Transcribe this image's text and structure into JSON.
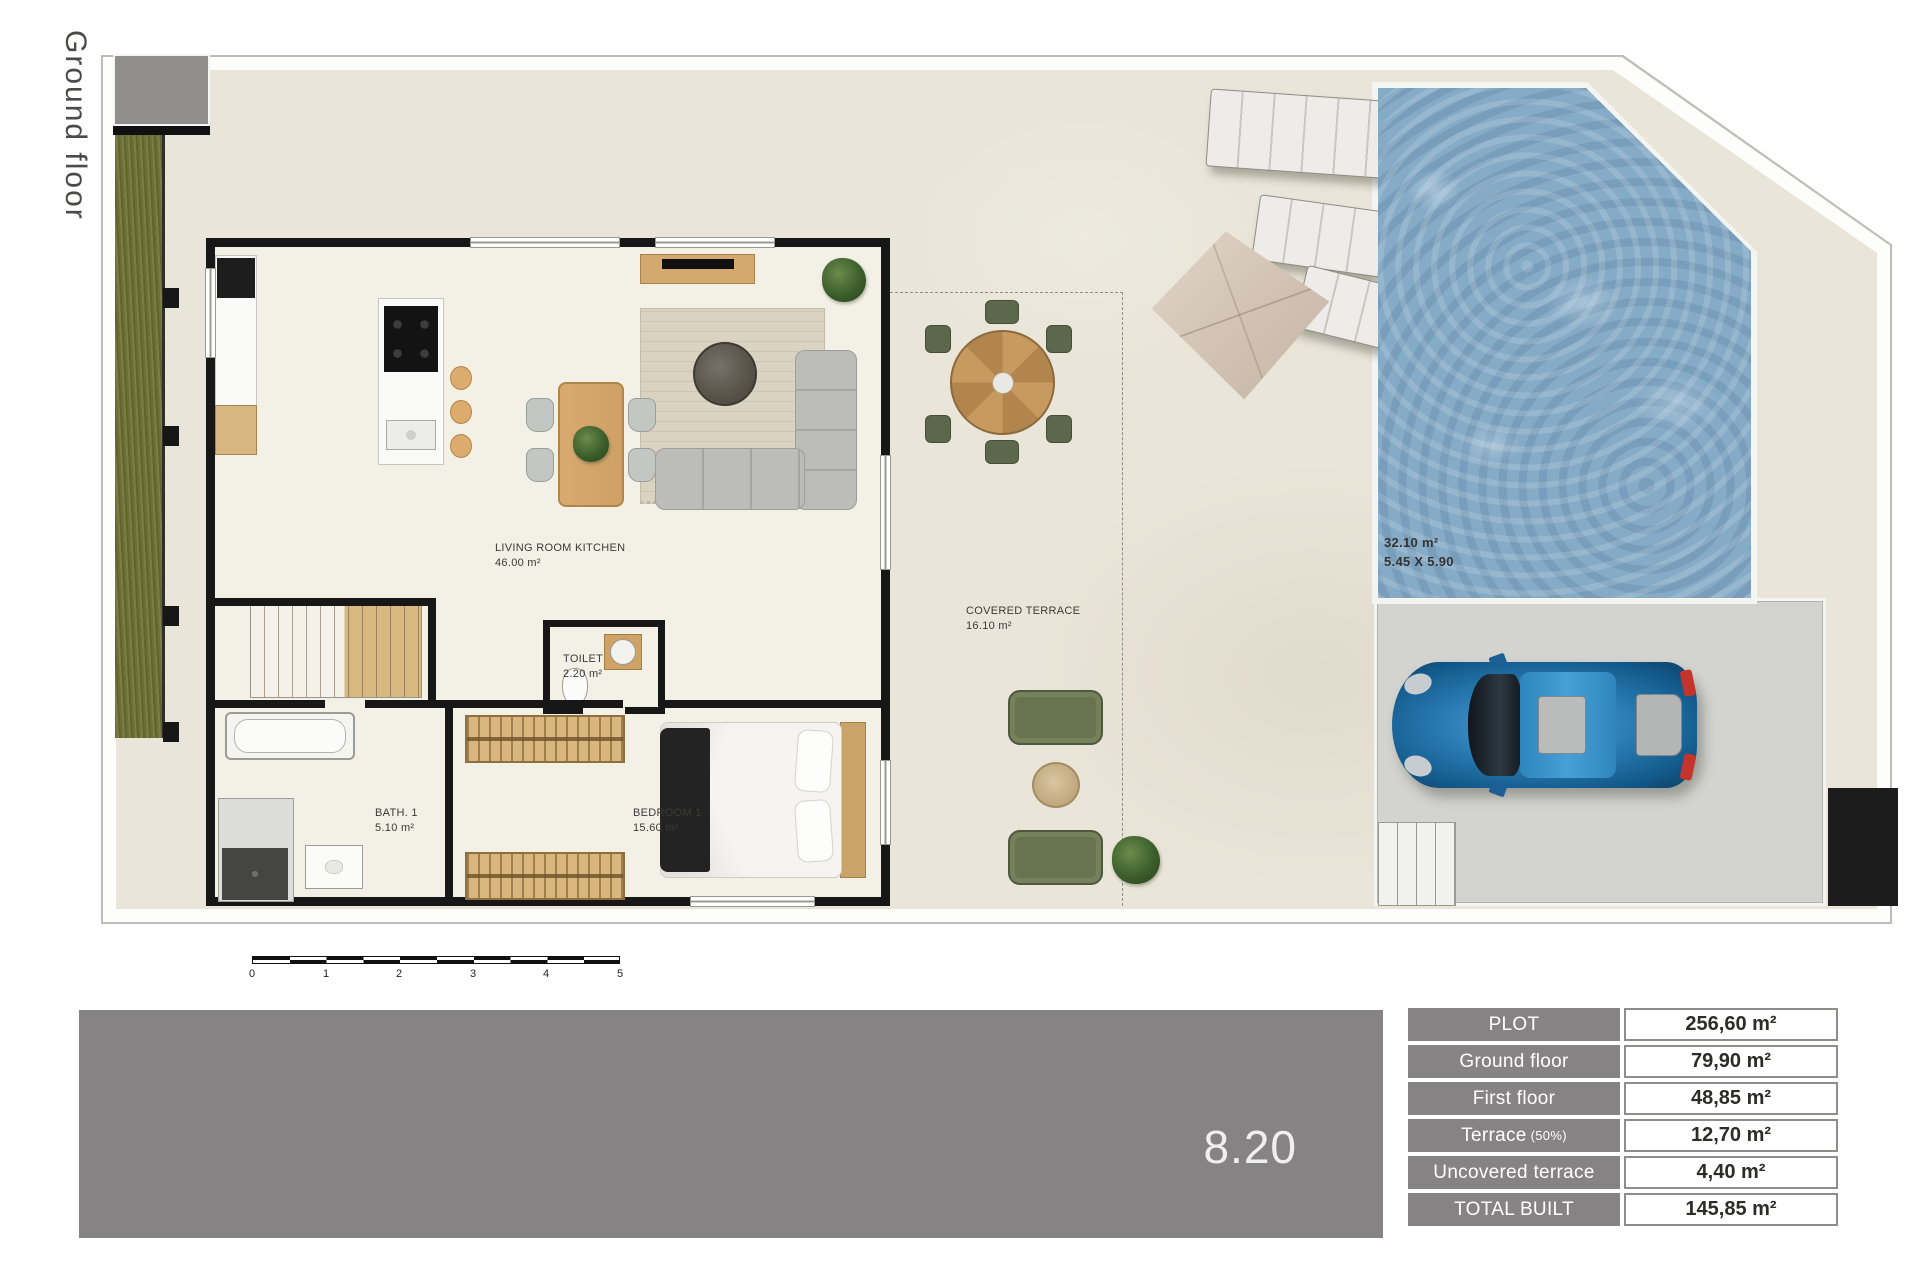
{
  "page": {
    "floor_label": "Ground floor",
    "unit_number": "8.20"
  },
  "plan": {
    "rooms": [
      {
        "name": "LIVING ROOM KITCHEN",
        "area": "46.00 m²"
      },
      {
        "name": "TOILET",
        "area": "2.20 m²"
      },
      {
        "name": "BATH. 1",
        "area": "5.10 m²"
      },
      {
        "name": "BEDROOM 1",
        "area": "15.60 m²"
      },
      {
        "name": "COVERED TERRACE",
        "area": "16.10 m²"
      }
    ],
    "pool": {
      "area": "32.10 m²",
      "dimensions": "5.45 X 5.90"
    },
    "scale_ticks": [
      "0",
      "1",
      "2",
      "3",
      "4",
      "5"
    ]
  },
  "areas_table": {
    "rows": [
      {
        "label": "PLOT",
        "value": "256,60 m²"
      },
      {
        "label": "Ground floor",
        "value": "79,90 m²"
      },
      {
        "label": "First floor",
        "value": "48,85 m²"
      },
      {
        "label": "Terrace",
        "label_note": "(50%)",
        "value": "12,70 m²"
      },
      {
        "label": "Uncovered terrace",
        "value": "4,40 m²"
      },
      {
        "label": "TOTAL BUILT",
        "value": "145,85 m²"
      }
    ]
  },
  "colors": {
    "panel_gray": "#868384",
    "floor_beige": "#e9e5d8",
    "pool_water": "#86abc7",
    "grass_green": "#6f7038",
    "car_blue": "#2a7cb4",
    "wall_black": "#171717"
  }
}
